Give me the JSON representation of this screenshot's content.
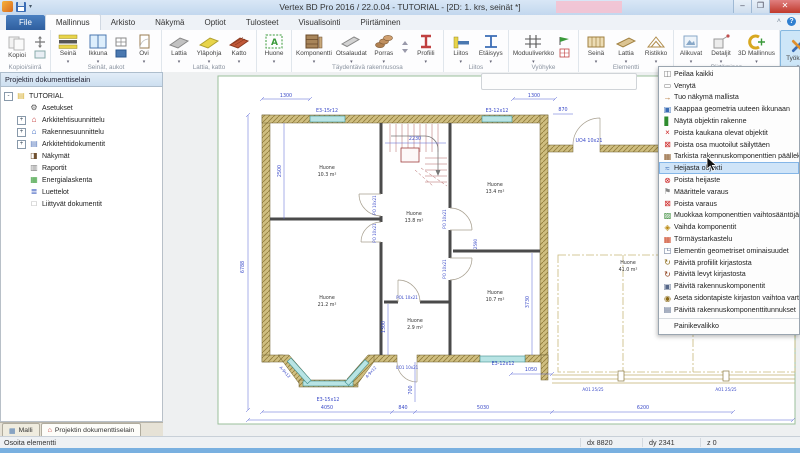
{
  "titlebar": {
    "title": "Vertex BD Pro 2016 / 22.0.04 - TUTORIAL - [2D: 1. krs, seinät *]"
  },
  "window_buttons": {
    "minimize": "–",
    "maximize": "❐",
    "close": "✕"
  },
  "tabs": [
    {
      "label": "File",
      "cls": "file"
    },
    {
      "label": "Mallinnus",
      "cls": "active"
    },
    {
      "label": "Arkisto"
    },
    {
      "label": "Näkymä"
    },
    {
      "label": "Optiot"
    },
    {
      "label": "Tulosteet"
    },
    {
      "label": "Visualisointi"
    },
    {
      "label": "Piirtäminen"
    }
  ],
  "ribbon": {
    "buttons": {
      "kopioi": "Kopioi",
      "seina": "Seinä",
      "ikkuna": "Ikkuna",
      "ovi": "Ovi",
      "lattia": "Lattia",
      "ylapohja": "Yläpohja",
      "katto": "Katto",
      "huone": "Huone",
      "komponentti": "Komponentti",
      "otsalaudat": "Otsalaudat",
      "porras": "Porras",
      "profiili": "Profiili",
      "liitos": "Liitos",
      "etaisyys": "Etäisyys",
      "moduuliverkko": "Moduuliverkko",
      "seina2": "Seinä",
      "lattia2": "Lattia",
      "ristikko": "Ristikko",
      "alikuvat": "Alikuvat",
      "detaljit": "Detaljit",
      "mallinnus3d": "3D Mallinnus",
      "tyokalut": "Työkalut"
    },
    "groups": {
      "g1": "Kopioi/siirrä",
      "g2": "Seinät, aukot",
      "g3": "Lattia, katto",
      "g4": "Täydentävä rakennusosa",
      "g5": "Liitos",
      "g6": "Vyöhyke",
      "g7": "Elementti",
      "g8": "Piirtäminen"
    }
  },
  "sidebar": {
    "header": "Projektin dokumenttiselain",
    "items": [
      {
        "label": "TUTORIAL",
        "glyph": "▤",
        "color": "#d8b33c",
        "exp": "-"
      },
      {
        "label": "Asetukset",
        "glyph": "⚙",
        "color": "#555555",
        "cls": "ind"
      },
      {
        "label": "Arkkitehtisuunnittelu",
        "glyph": "⌂",
        "color": "#c03030",
        "exp": "+",
        "cls": "ind"
      },
      {
        "label": "Rakennesuunnittelu",
        "glyph": "⌂",
        "color": "#3060c0",
        "exp": "+",
        "cls": "ind"
      },
      {
        "label": "Arkkitehtidokumentit",
        "glyph": "▤",
        "color": "#6080c0",
        "exp": "+",
        "cls": "ind"
      },
      {
        "label": "Näkymät",
        "glyph": "◨",
        "color": "#705030",
        "cls": "ind"
      },
      {
        "label": "Raportit",
        "glyph": "▥",
        "color": "#808080",
        "cls": "ind"
      },
      {
        "label": "Energialaskenta",
        "glyph": "▦",
        "color": "#40a040",
        "cls": "ind"
      },
      {
        "label": "Luettelot",
        "glyph": "≣",
        "color": "#4060c0",
        "cls": "ind"
      },
      {
        "label": "Liittyvät dokumentit",
        "glyph": "□",
        "color": "#888888",
        "cls": "ind"
      }
    ],
    "bottom_tabs": [
      {
        "label": "Malli",
        "glyph": "▦",
        "color": "#4a78b0"
      },
      {
        "label": "Projektin dokumenttiselain",
        "glyph": "⌂",
        "color": "#c03030",
        "cls": "active"
      }
    ]
  },
  "canvas_toolbar": [
    {
      "glyph": "≣",
      "color": "#3a9a5a"
    },
    {
      "glyph": "≈",
      "color": "#3a9aa0"
    },
    {
      "glyph": "≡",
      "color": "#708090"
    },
    {
      "glyph": "−",
      "color": "#999999"
    },
    {
      "glyph": "↩",
      "color": "#20a8b0"
    },
    {
      "glyph": "□",
      "color": "#999999"
    },
    {
      "glyph": "◉",
      "color": "#d04040"
    },
    {
      "glyph": "▭",
      "color": "#999999"
    },
    {
      "glyph": "▽",
      "color": "#8090a0"
    },
    {
      "glyph": "▣",
      "color": "#5a90c8"
    }
  ],
  "menu": [
    {
      "label": "Peilaa kaikki",
      "glyph": "◫",
      "color": "#7a7a7a"
    },
    {
      "label": "Venytä",
      "glyph": "▭",
      "color": "#7a7a7a"
    },
    {
      "label": "Tuo näkymä mallista",
      "glyph": "→",
      "color": "#b07030"
    },
    {
      "label": "Kaappaa geometria uuteen ikkunaan",
      "glyph": "▣",
      "color": "#3a6cb5"
    },
    {
      "label": "Näytä objektin rakenne",
      "glyph": "▋",
      "color": "#2e8b2e"
    },
    {
      "label": "Poista kaukana olevat objektit",
      "glyph": "×",
      "color": "#cc2222"
    },
    {
      "label": "Poista osa muotoilut säilyttäen",
      "glyph": "⊠",
      "color": "#cc2222"
    },
    {
      "label": "Tarkista rakennuskomponenttien päällekkäisyydet",
      "glyph": "▦",
      "color": "#8a5a2a"
    },
    {
      "label": "Heijasta objekti",
      "glyph": "≈",
      "color": "#3a6cb5",
      "highlight": true
    },
    {
      "label": "Poista heijaste",
      "glyph": "⊗",
      "color": "#cc2222"
    },
    {
      "label": "Määrittele varaus",
      "glyph": "⚑",
      "color": "#888888"
    },
    {
      "label": "Poista varaus",
      "glyph": "⊠",
      "color": "#cc2222"
    },
    {
      "label": "Muokkaa komponenttien vaihtosääntöjä",
      "glyph": "▨",
      "color": "#3a8b3a"
    },
    {
      "label": "Vaihda komponentit",
      "glyph": "◈",
      "color": "#b8860b"
    },
    {
      "label": "Törmäystarkastelu",
      "glyph": "▦",
      "color": "#cc4422"
    },
    {
      "label": "Elementin geometriset ominaisuudet",
      "glyph": "◳",
      "color": "#556688"
    },
    {
      "label": "Päivitä profiilit kirjastosta",
      "glyph": "↻",
      "color": "#8b6914"
    },
    {
      "label": "Päivitä levyt kirjastosta",
      "glyph": "↻",
      "color": "#8b3a14"
    },
    {
      "label": "Päivitä rakennuskomponentit",
      "glyph": "▣",
      "color": "#556688"
    },
    {
      "label": "Aseta sidontapiste kirjaston vaihtoa varten",
      "glyph": "◉",
      "color": "#8b6914"
    },
    {
      "label": "Päivitä rakennuskomponenttitunnukset",
      "glyph": "▤",
      "color": "#556688"
    },
    {
      "label": "Painikevalikko",
      "glyph": "",
      "color": "#556688",
      "sep": true
    }
  ],
  "plan": {
    "rooms": [
      {
        "n": "Huone",
        "a": "10.3 m²"
      },
      {
        "n": "Huone",
        "a": "13.8 m²"
      },
      {
        "n": "Huone",
        "a": "13.4 m²"
      },
      {
        "n": "Huone",
        "a": "21.2 m²"
      },
      {
        "n": "Huone",
        "a": "10.7 m²"
      },
      {
        "n": "Huone",
        "a": "2.9 m²"
      },
      {
        "n": "Huone",
        "a": "41.0 m²"
      }
    ],
    "labels": {
      "dim_top_left": "1300",
      "dim_top_right": "1300",
      "dim_step": "870",
      "dim_left": "6788",
      "dim_tl_height": "2500",
      "dim_stairs": "2230",
      "dim_br_height": "3730",
      "dim_mid": "2590",
      "dim_small": "1300",
      "dim_door": "700",
      "dim_wing": "1050",
      "dim_b1": "4050",
      "dim_b2": "840",
      "dim_b3": "5030",
      "dim_b4": "6200",
      "win_top_left": "E3-15r12",
      "win_top_right": "E3-12x12",
      "win_bottom": "E3-12x12",
      "win_bay": "E3-15x12",
      "win_bay_left": "A-9x12",
      "win_bay_right": "A-9x12",
      "door_wing": "UO4 10x21",
      "door_bottom": "UO1 10x21",
      "door_small": "POL 10x21",
      "door_a": "PO 10x21",
      "door_b": "PO 10x21",
      "door_c": "PO 10x21",
      "door_d": "PO 10x21",
      "post_left": "AO1 25/25",
      "post_right": "AO1 25/25"
    }
  },
  "statusbar": {
    "prompt": "Osoita elementti",
    "dx": "dx 8820",
    "dy": "dy 2341",
    "z": "z 0"
  },
  "colors": {
    "accent": "#3a6cb5",
    "menu_highlight": "#cfe4f8",
    "wall": "#cfbe80",
    "dim": "#3a4ac8"
  }
}
